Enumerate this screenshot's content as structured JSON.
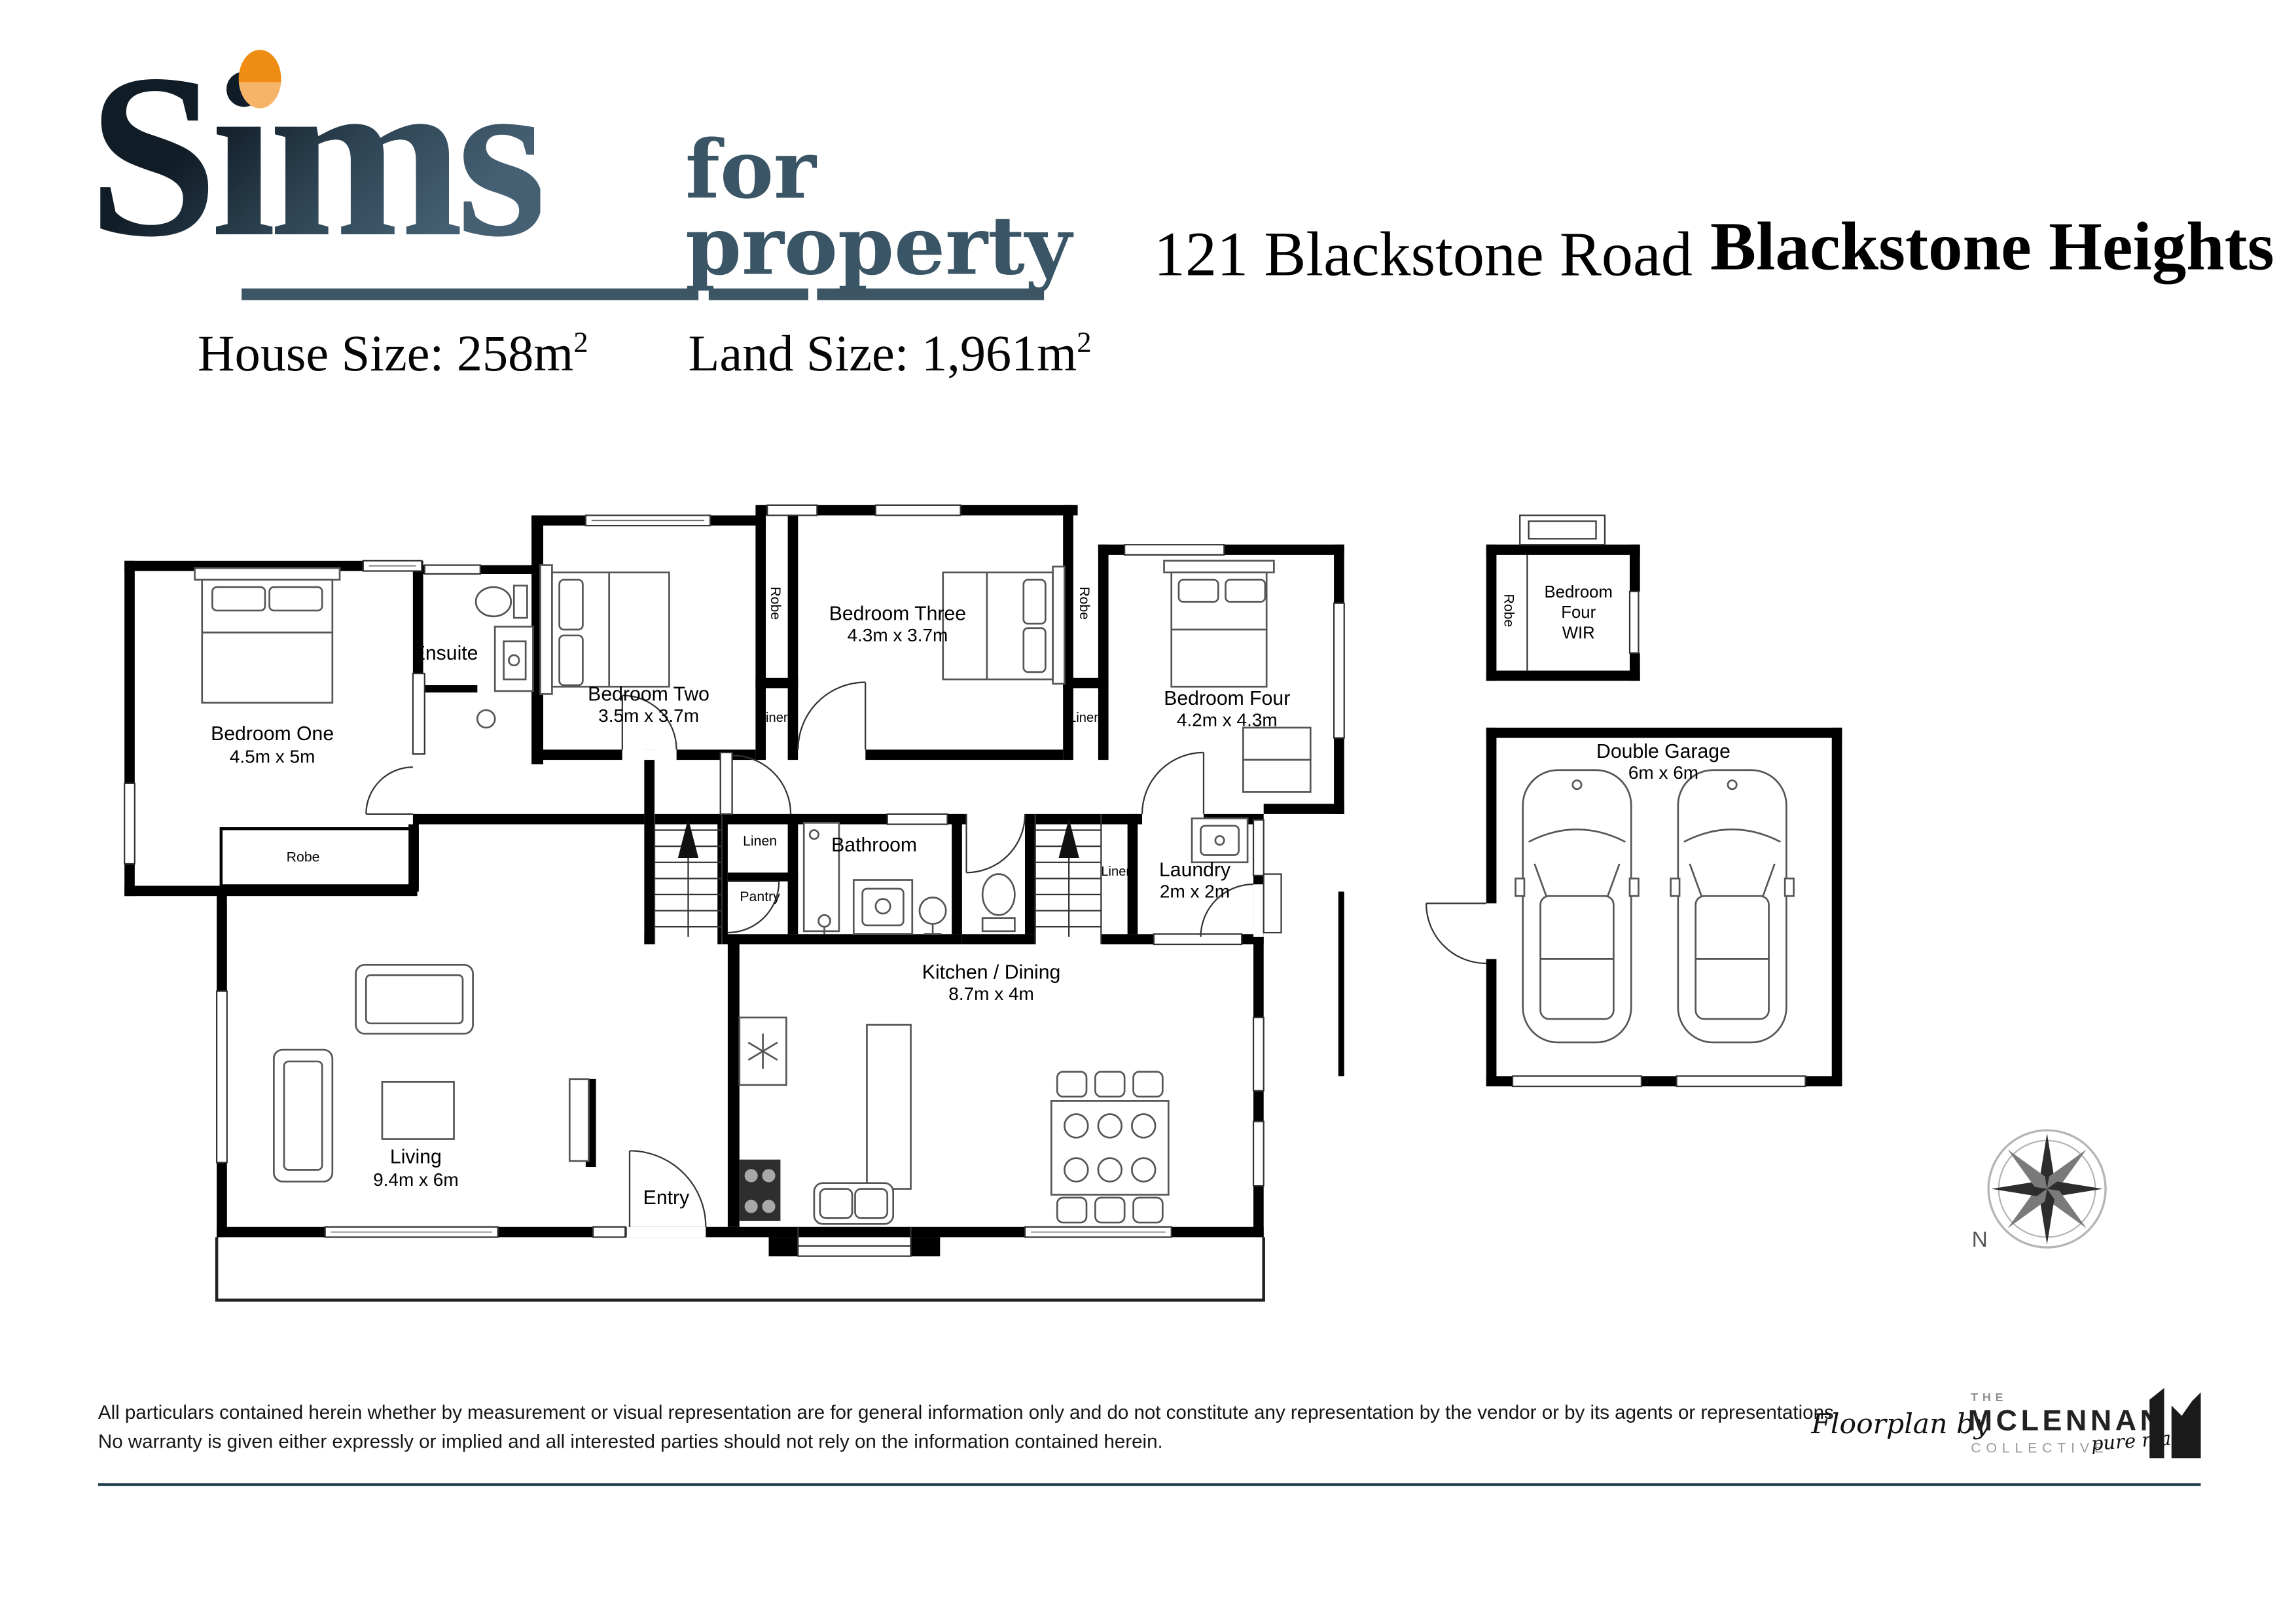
{
  "header": {
    "brand_word": "Sims",
    "brand_for": "for",
    "brand_property": "property",
    "address": "121 Blackstone Road",
    "suburb": "Blackstone Heights",
    "house_size_label": "House Size: ",
    "house_size_value": "258m",
    "house_size_sup": "2",
    "land_size_label": "Land Size: ",
    "land_size_value": "1,961m",
    "land_size_sup": "2"
  },
  "plan": {
    "bedroom_one_name": "Bedroom One",
    "bedroom_one_dims": "4.5m x 5m",
    "ensuite_name": "Ensuite",
    "bedroom_two_name": "Bedroom Two",
    "bedroom_two_dims": "3.5m x 3.7m",
    "bedroom_three_name": "Bedroom Three",
    "bedroom_three_dims": "4.3m x 3.7m",
    "bedroom_four_name": "Bedroom Four",
    "bedroom_four_dims": "4.2m x 4.3m",
    "wir_line1": "Bedroom",
    "wir_line2": "Four",
    "wir_line3": "WIR",
    "bathroom_name": "Bathroom",
    "laundry_name": "Laundry",
    "laundry_dims": "2m x 2m",
    "kitchen_name": "Kitchen / Dining",
    "kitchen_dims": "8.7m x 4m",
    "living_name": "Living",
    "living_dims": "9.4m x 6m",
    "entry_name": "Entry",
    "garage_name": "Double Garage",
    "garage_dims": "6m x 6m",
    "robe_label": "Robe",
    "linen_label": "Linen",
    "pantry_label": "Pantry",
    "compass_n": "N"
  },
  "footer": {
    "disclaimer_line1": "All particulars contained herein whether by measurement or visual representation are for general information only and do not constitute any representation by the vendor or by its agents or representations.",
    "disclaimer_line2": "No warranty is given either expressly or implied and all interested parties should not rely on the information contained herein.",
    "floorplan_by": "Floorplan by",
    "logo_the": "THE",
    "logo_name": "MCLENNAN",
    "logo_collective": "COLLECTIVE",
    "logo_script": "pure magic"
  },
  "colors": {
    "brand_dark": "#101c26",
    "brand_steel": "#3d5666",
    "brand_orange": "#ef8c13",
    "rule": "#1e3d4d"
  }
}
